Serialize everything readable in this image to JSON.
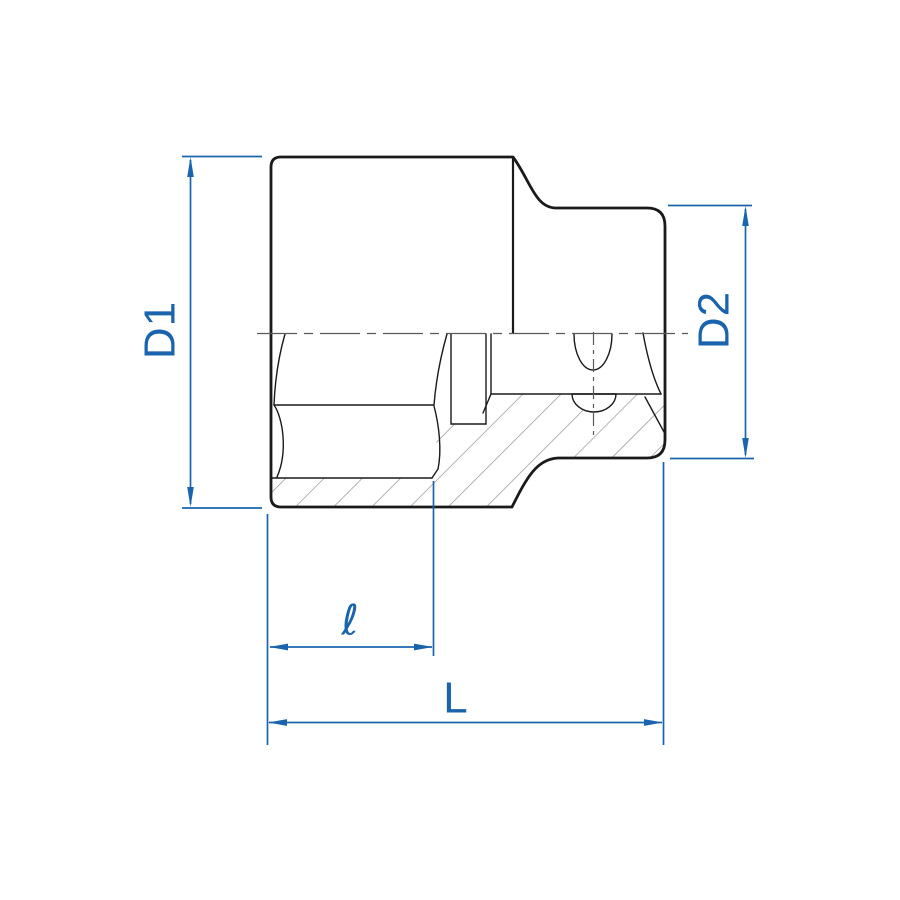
{
  "drawing": {
    "description_labels": {
      "d1": "D1",
      "d2": "D2",
      "length_partial": "ℓ",
      "length_total": "L"
    }
  },
  "colors": {
    "background": "#ffffff",
    "outline": "#1a1a1a",
    "centerline": "#5a5a5a",
    "hatch": "#8c8c8c",
    "dimension": "#1a64ae"
  }
}
